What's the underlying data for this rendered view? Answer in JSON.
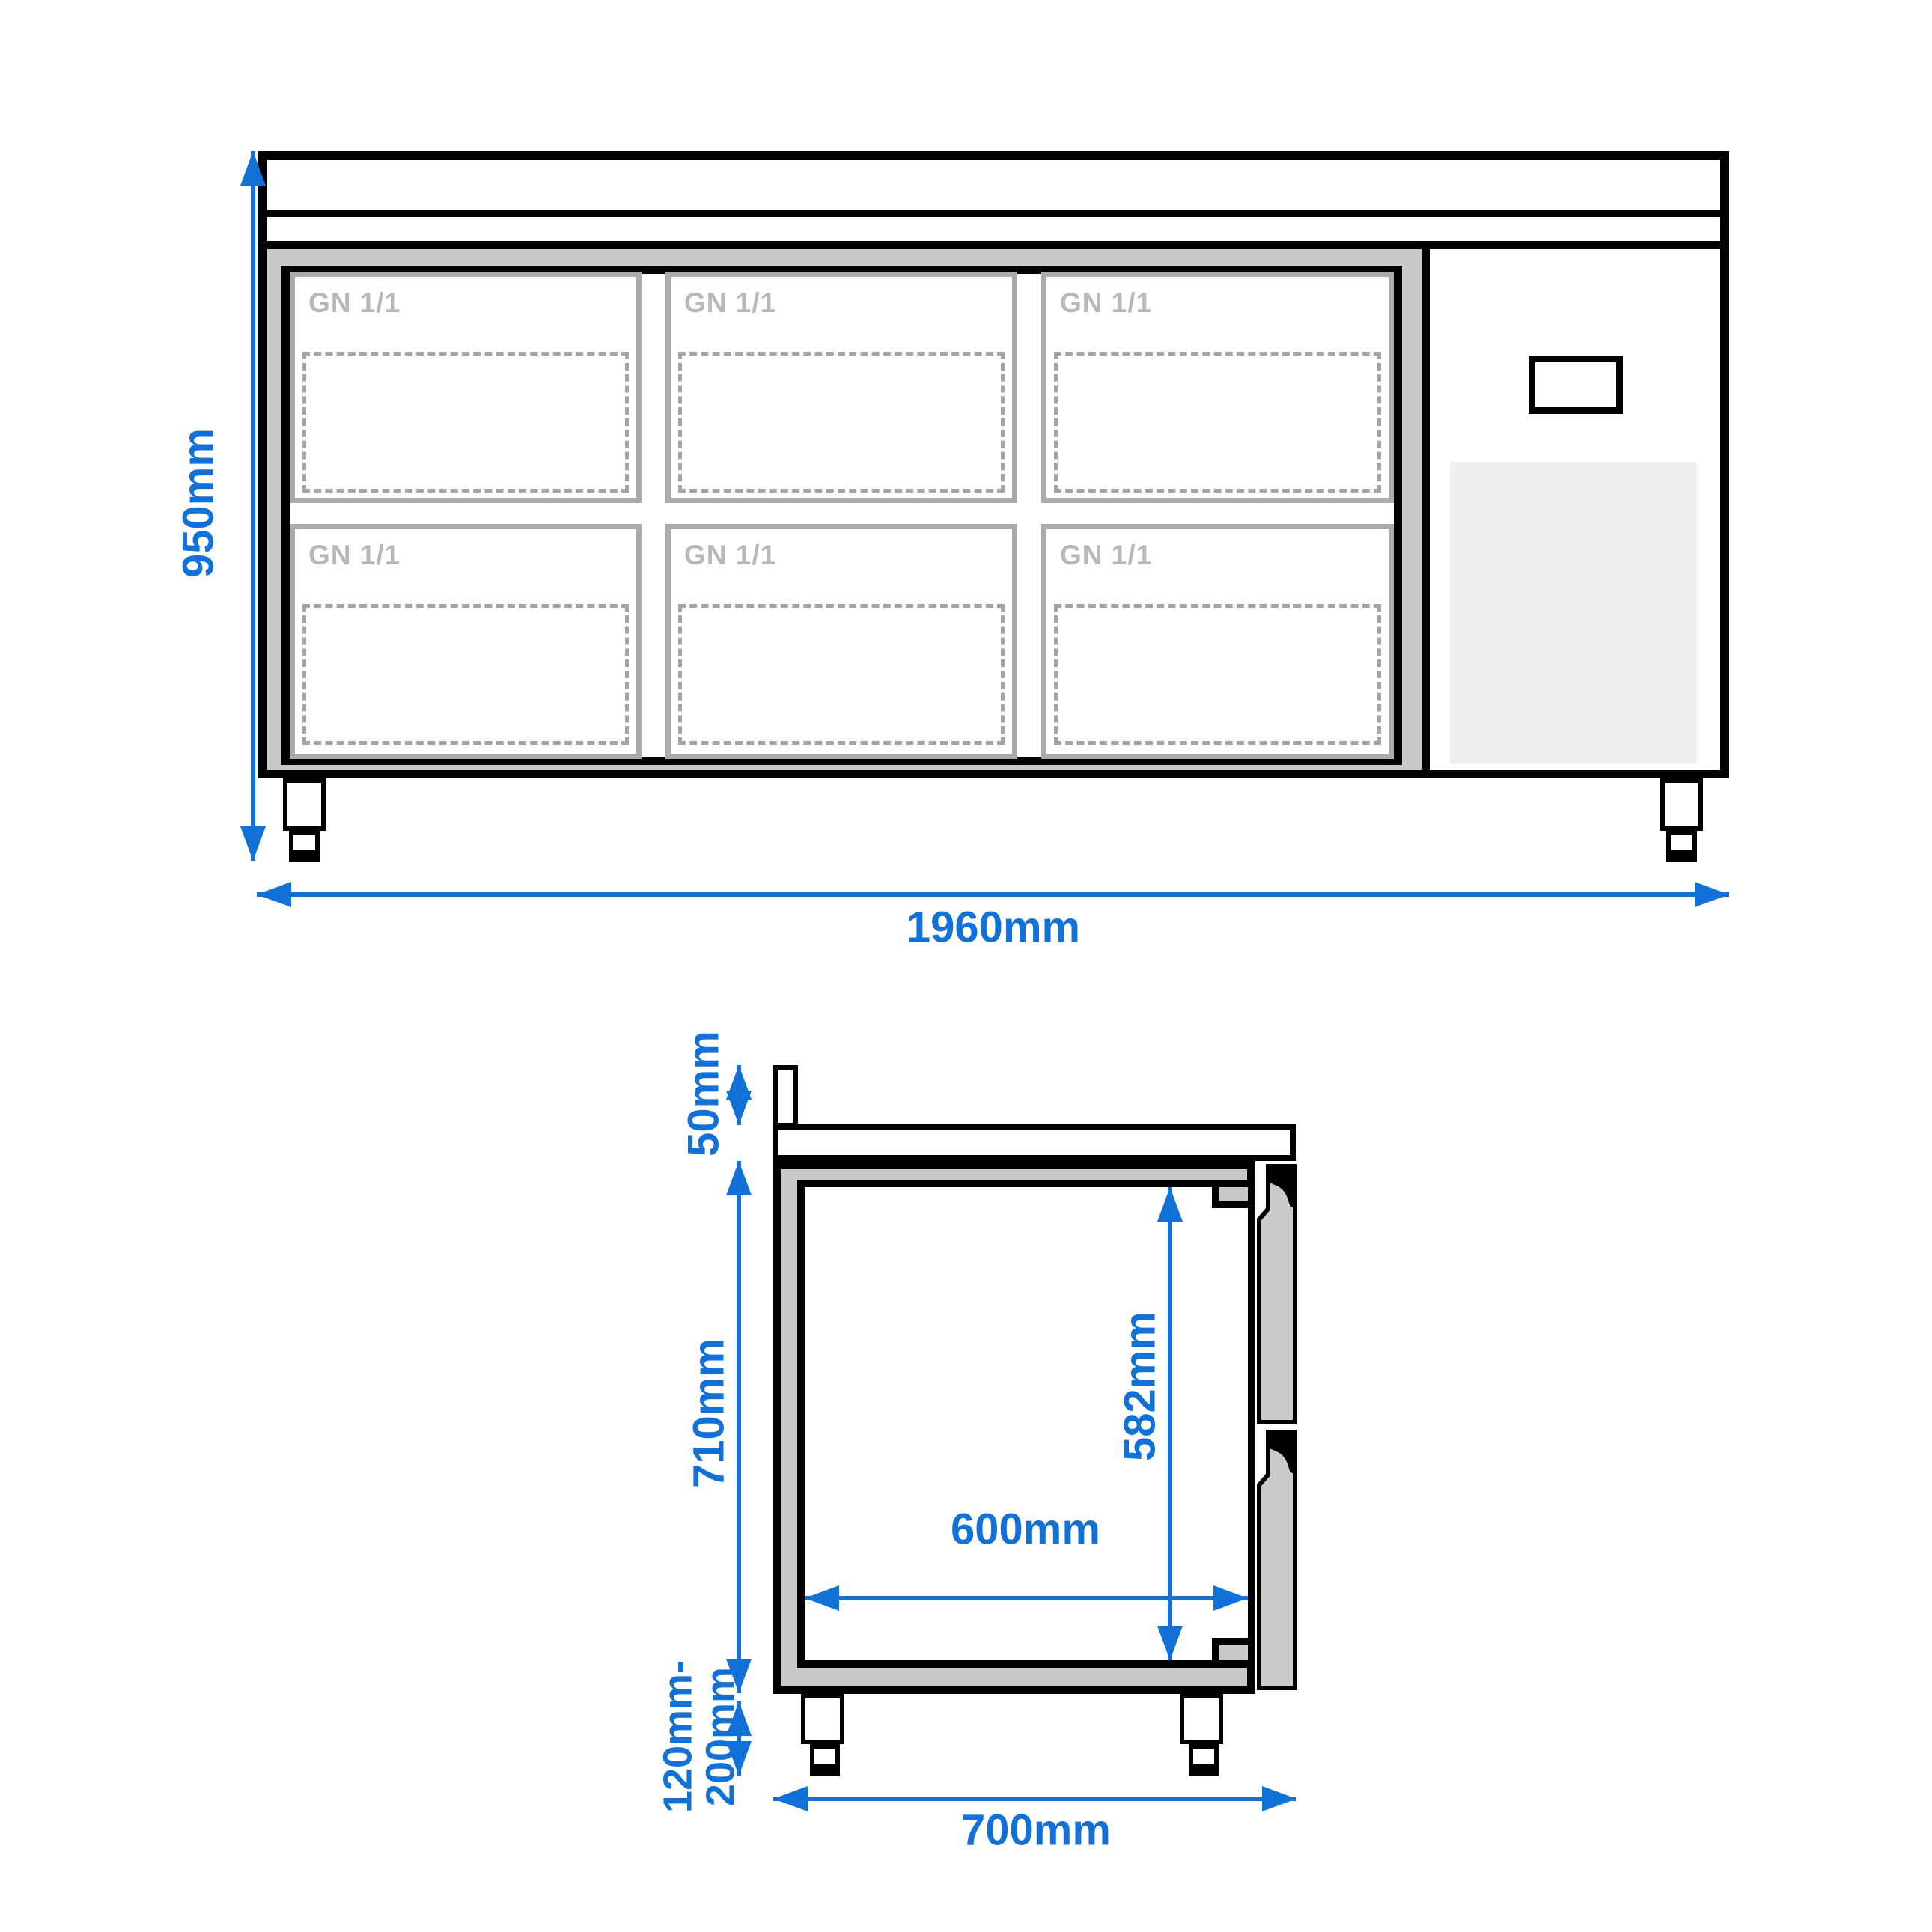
{
  "drawing": {
    "type": "technical dimension drawing",
    "subject": "refrigerated counter with GN 1/1 compartments, front view and side section view"
  },
  "colors": {
    "accent_blue": "#1271D6",
    "insulation_gray": "#C9C9C9",
    "cell_border_gray": "#ABABAB",
    "gn_text_gray": "#B8B8B8",
    "dash_gray": "#A4A4A4",
    "vent_gray": "#EEEEEE",
    "drawer_gray": "#CBCBCB",
    "line_black": "#000000"
  },
  "front_view": {
    "cells": [
      {
        "label": "GN 1/1"
      },
      {
        "label": "GN 1/1"
      },
      {
        "label": "GN 1/1"
      },
      {
        "label": "GN 1/1"
      },
      {
        "label": "GN 1/1"
      },
      {
        "label": "GN 1/1"
      }
    ],
    "dimensions": {
      "total_height": "950mm",
      "total_width": "1960mm"
    }
  },
  "side_view": {
    "dimensions": {
      "upstand_height": "50mm",
      "body_height": "710mm",
      "interior_height": "582mm",
      "interior_depth": "600mm",
      "leg_height_line1": "120mm-",
      "leg_height_line2": "200mm",
      "total_depth": "700mm"
    }
  }
}
